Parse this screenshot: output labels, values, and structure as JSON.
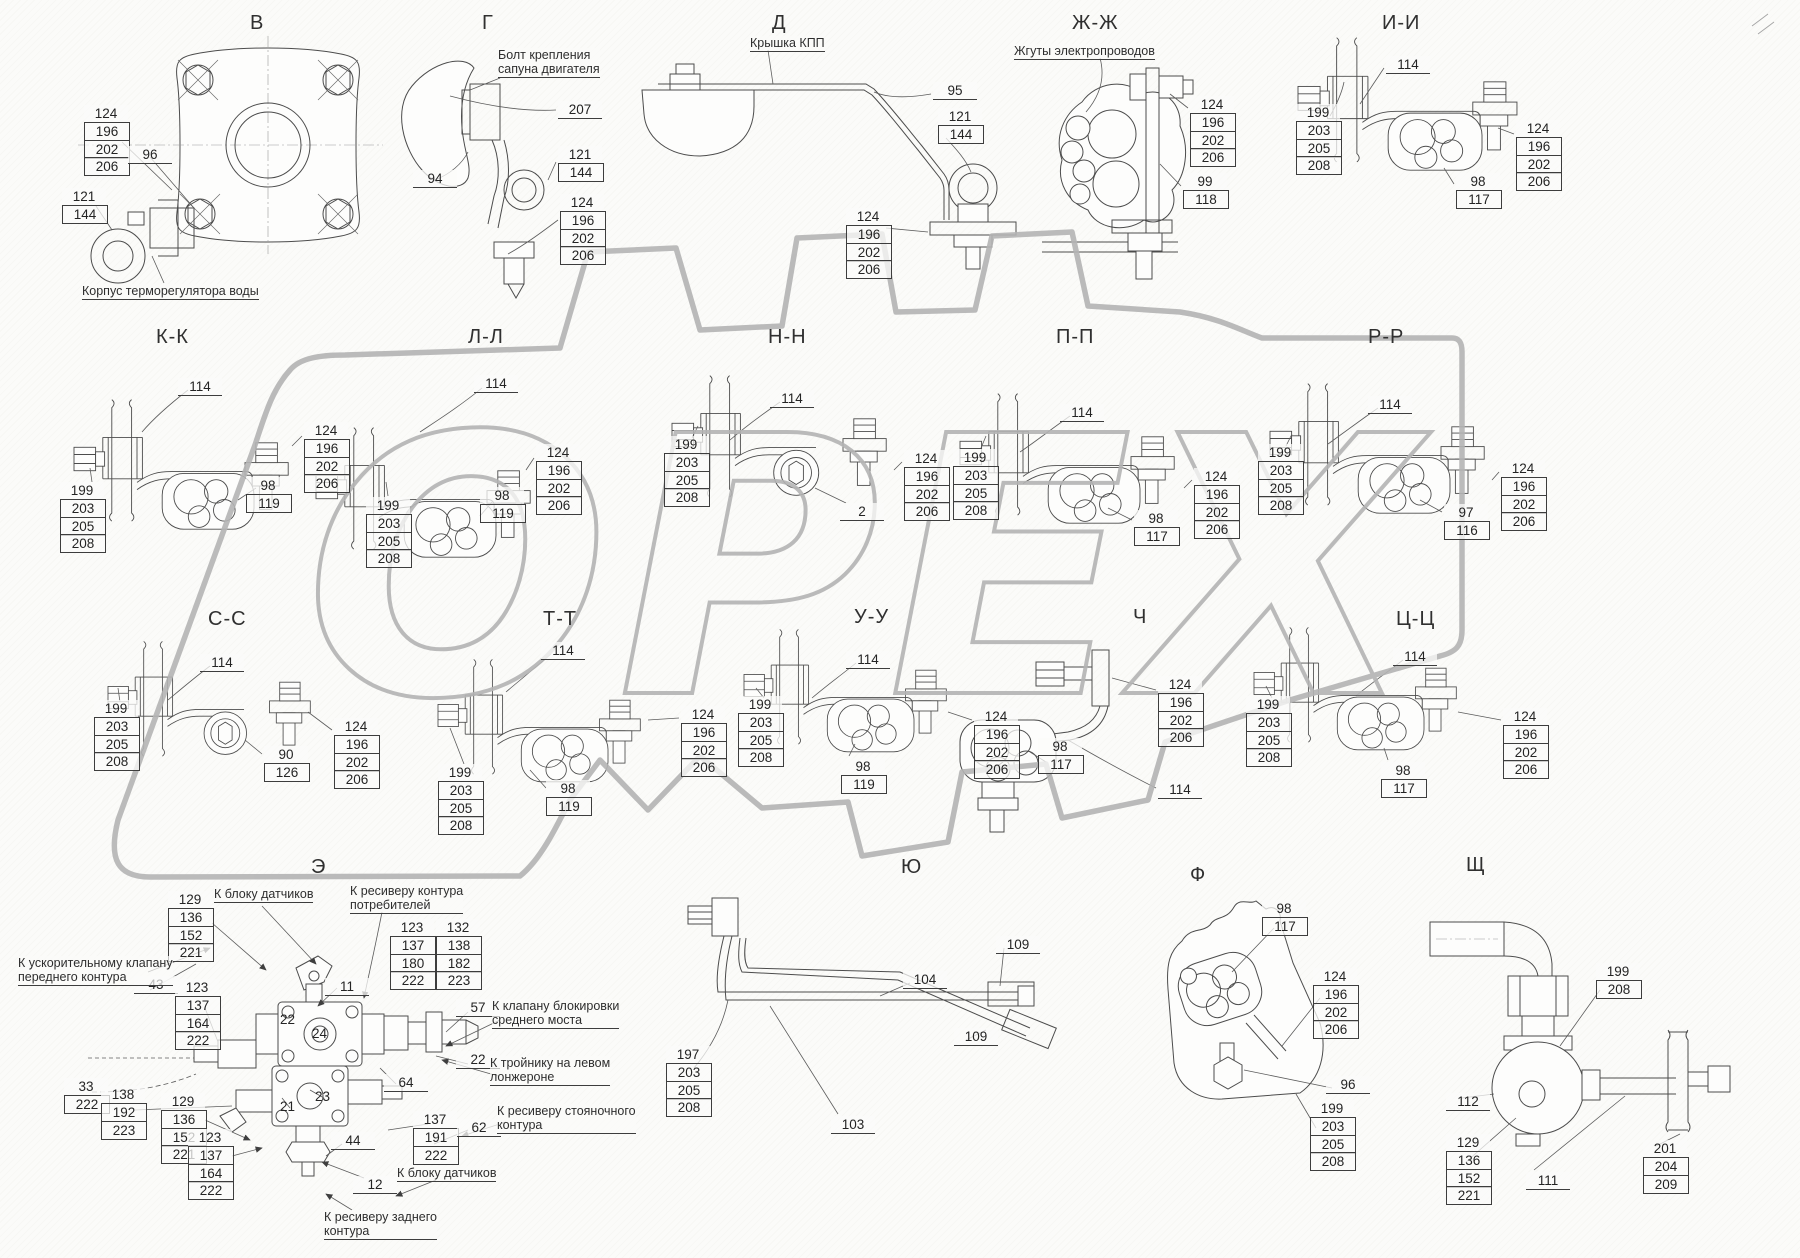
{
  "watermark": {
    "text": "ОРЕХ",
    "color": "#b4b4b4"
  },
  "sections": [
    {
      "key": "v",
      "title": "В",
      "x": 250,
      "y": 12,
      "callouts": [
        {
          "x": 84,
          "y": 105,
          "v": [
            "124",
            "196",
            "202",
            "206"
          ]
        },
        {
          "x": 128,
          "y": 146,
          "v": [
            "96"
          ]
        },
        {
          "x": 62,
          "y": 188,
          "v": [
            "121",
            "144"
          ]
        }
      ],
      "notes": [
        {
          "x": 82,
          "y": 284,
          "lines": [
            "Корпус терморегулятора воды"
          ]
        }
      ]
    },
    {
      "key": "g",
      "title": "Г",
      "x": 482,
      "y": 12,
      "callouts": [
        {
          "x": 558,
          "y": 101,
          "v": [
            "207"
          ]
        },
        {
          "x": 413,
          "y": 170,
          "v": [
            "94"
          ]
        },
        {
          "x": 558,
          "y": 146,
          "v": [
            "121",
            "144"
          ]
        },
        {
          "x": 560,
          "y": 194,
          "v": [
            "124",
            "196",
            "202",
            "206"
          ]
        }
      ],
      "notes": [
        {
          "x": 498,
          "y": 48,
          "lines": [
            "Болт крепления",
            "сапуна двигателя"
          ]
        }
      ]
    },
    {
      "key": "d",
      "title": "Д",
      "x": 772,
      "y": 12,
      "callouts": [
        {
          "x": 933,
          "y": 82,
          "v": [
            "95"
          ]
        },
        {
          "x": 938,
          "y": 108,
          "v": [
            "121",
            "144"
          ]
        },
        {
          "x": 846,
          "y": 208,
          "v": [
            "124",
            "196",
            "202",
            "206"
          ]
        }
      ],
      "notes": [
        {
          "x": 750,
          "y": 36,
          "lines": [
            "Крышка КПП"
          ]
        }
      ]
    },
    {
      "key": "zh",
      "title": "Ж-Ж",
      "x": 1072,
      "y": 12,
      "callouts": [
        {
          "x": 1190,
          "y": 96,
          "v": [
            "124",
            "196",
            "202",
            "206"
          ]
        },
        {
          "x": 1183,
          "y": 173,
          "v": [
            "99",
            "118"
          ]
        }
      ],
      "notes": [
        {
          "x": 1014,
          "y": 44,
          "lines": [
            "Жгуты электропроводов"
          ]
        }
      ]
    },
    {
      "key": "i",
      "title": "И-И",
      "x": 1382,
      "y": 12,
      "callouts": [
        {
          "x": 1386,
          "y": 56,
          "v": [
            "114"
          ]
        },
        {
          "x": 1296,
          "y": 104,
          "v": [
            "199",
            "203",
            "205",
            "208"
          ]
        },
        {
          "x": 1516,
          "y": 120,
          "v": [
            "124",
            "196",
            "202",
            "206"
          ]
        },
        {
          "x": 1456,
          "y": 173,
          "v": [
            "98",
            "117"
          ]
        }
      ],
      "notes": []
    },
    {
      "key": "k",
      "title": "К-К",
      "x": 156,
      "y": 326,
      "callouts": [
        {
          "x": 178,
          "y": 378,
          "v": [
            "114"
          ]
        },
        {
          "x": 304,
          "y": 422,
          "v": [
            "124",
            "196",
            "202",
            "206"
          ]
        },
        {
          "x": 246,
          "y": 477,
          "v": [
            "98",
            "119"
          ]
        },
        {
          "x": 60,
          "y": 482,
          "v": [
            "199",
            "203",
            "205",
            "208"
          ]
        }
      ],
      "notes": []
    },
    {
      "key": "l",
      "title": "Л-Л",
      "x": 468,
      "y": 326,
      "callouts": [
        {
          "x": 474,
          "y": 375,
          "v": [
            "114"
          ]
        },
        {
          "x": 536,
          "y": 444,
          "v": [
            "124",
            "196",
            "202",
            "206"
          ]
        },
        {
          "x": 480,
          "y": 487,
          "v": [
            "98",
            "119"
          ]
        },
        {
          "x": 366,
          "y": 497,
          "v": [
            "199",
            "203",
            "205",
            "208"
          ]
        }
      ],
      "notes": []
    },
    {
      "key": "n",
      "title": "Н-Н",
      "x": 768,
      "y": 326,
      "callouts": [
        {
          "x": 770,
          "y": 390,
          "v": [
            "114"
          ]
        },
        {
          "x": 664,
          "y": 436,
          "v": [
            "199",
            "203",
            "205",
            "208"
          ]
        },
        {
          "x": 904,
          "y": 450,
          "v": [
            "124",
            "196",
            "202",
            "206"
          ]
        },
        {
          "x": 840,
          "y": 503,
          "v": [
            "2"
          ]
        }
      ],
      "notes": []
    },
    {
      "key": "p",
      "title": "П-П",
      "x": 1056,
      "y": 326,
      "callouts": [
        {
          "x": 1060,
          "y": 404,
          "v": [
            "114"
          ]
        },
        {
          "x": 953,
          "y": 449,
          "v": [
            "199",
            "203",
            "205",
            "208"
          ]
        },
        {
          "x": 1194,
          "y": 468,
          "v": [
            "124",
            "196",
            "202",
            "206"
          ]
        },
        {
          "x": 1134,
          "y": 510,
          "v": [
            "98",
            "117"
          ]
        }
      ],
      "notes": []
    },
    {
      "key": "r",
      "title": "Р-Р",
      "x": 1368,
      "y": 326,
      "callouts": [
        {
          "x": 1368,
          "y": 396,
          "v": [
            "114"
          ]
        },
        {
          "x": 1258,
          "y": 444,
          "v": [
            "199",
            "203",
            "205",
            "208"
          ]
        },
        {
          "x": 1444,
          "y": 504,
          "v": [
            "97",
            "116"
          ]
        },
        {
          "x": 1501,
          "y": 460,
          "v": [
            "124",
            "196",
            "202",
            "206"
          ]
        }
      ],
      "notes": []
    },
    {
      "key": "s",
      "title": "С-С",
      "x": 208,
      "y": 608,
      "callouts": [
        {
          "x": 200,
          "y": 654,
          "v": [
            "114"
          ]
        },
        {
          "x": 94,
          "y": 700,
          "v": [
            "199",
            "203",
            "205",
            "208"
          ]
        },
        {
          "x": 264,
          "y": 746,
          "v": [
            "90",
            "126"
          ]
        },
        {
          "x": 334,
          "y": 718,
          "v": [
            "124",
            "196",
            "202",
            "206"
          ]
        }
      ],
      "notes": []
    },
    {
      "key": "t",
      "title": "Т-Т",
      "x": 543,
      "y": 608,
      "callouts": [
        {
          "x": 541,
          "y": 642,
          "v": [
            "114"
          ]
        },
        {
          "x": 438,
          "y": 764,
          "v": [
            "199",
            "203",
            "205",
            "208"
          ]
        },
        {
          "x": 546,
          "y": 780,
          "v": [
            "98",
            "119"
          ]
        },
        {
          "x": 681,
          "y": 706,
          "v": [
            "124",
            "196",
            "202",
            "206"
          ]
        }
      ],
      "notes": []
    },
    {
      "key": "u",
      "title": "У-У",
      "x": 854,
      "y": 606,
      "callouts": [
        {
          "x": 846,
          "y": 651,
          "v": [
            "114"
          ]
        },
        {
          "x": 738,
          "y": 696,
          "v": [
            "199",
            "203",
            "205",
            "208"
          ]
        },
        {
          "x": 841,
          "y": 758,
          "v": [
            "98",
            "119"
          ]
        },
        {
          "x": 974,
          "y": 708,
          "v": [
            "124",
            "196",
            "202",
            "206"
          ]
        }
      ],
      "notes": []
    },
    {
      "key": "ch",
      "title": "Ч",
      "x": 1133,
      "y": 606,
      "callouts": [
        {
          "x": 1158,
          "y": 676,
          "v": [
            "124",
            "196",
            "202",
            "206"
          ]
        },
        {
          "x": 1038,
          "y": 738,
          "v": [
            "98",
            "117"
          ]
        },
        {
          "x": 1158,
          "y": 781,
          "v": [
            "114"
          ]
        }
      ],
      "notes": []
    },
    {
      "key": "ts",
      "title": "Ц-Ц",
      "x": 1396,
      "y": 608,
      "callouts": [
        {
          "x": 1393,
          "y": 648,
          "v": [
            "114"
          ]
        },
        {
          "x": 1246,
          "y": 696,
          "v": [
            "199",
            "203",
            "205",
            "208"
          ]
        },
        {
          "x": 1381,
          "y": 762,
          "v": [
            "98",
            "117"
          ]
        },
        {
          "x": 1503,
          "y": 708,
          "v": [
            "124",
            "196",
            "202",
            "206"
          ]
        }
      ],
      "notes": []
    },
    {
      "key": "e",
      "title": "Э",
      "x": 311,
      "y": 856,
      "callouts": [
        {
          "x": 168,
          "y": 891,
          "v": [
            "129",
            "136",
            "152",
            "221"
          ]
        },
        {
          "x": 390,
          "y": 919,
          "v": [
            "123",
            "137",
            "180",
            "222"
          ]
        },
        {
          "x": 436,
          "y": 919,
          "v": [
            "132",
            "138",
            "182",
            "223"
          ]
        },
        {
          "x": 134,
          "y": 976,
          "v": [
            "43"
          ]
        },
        {
          "x": 175,
          "y": 979,
          "v": [
            "123",
            "137",
            "164",
            "222"
          ]
        },
        {
          "x": 325,
          "y": 978,
          "v": [
            "11"
          ]
        },
        {
          "x": 456,
          "y": 999,
          "v": [
            "57"
          ]
        },
        {
          "x": 456,
          "y": 1051,
          "v": [
            "22"
          ]
        },
        {
          "x": 384,
          "y": 1074,
          "v": [
            "64"
          ]
        },
        {
          "x": 64,
          "y": 1078,
          "v": [
            "33",
            "222"
          ]
        },
        {
          "x": 101,
          "y": 1086,
          "v": [
            "138",
            "192",
            "223"
          ]
        },
        {
          "x": 161,
          "y": 1093,
          "v": [
            "129",
            "136",
            "152",
            "221"
          ]
        },
        {
          "x": 188,
          "y": 1129,
          "v": [
            "123",
            "137",
            "164",
            "222"
          ]
        },
        {
          "x": 331,
          "y": 1132,
          "v": [
            "44"
          ]
        },
        {
          "x": 413,
          "y": 1111,
          "v": [
            "137",
            "191",
            "222"
          ]
        },
        {
          "x": 457,
          "y": 1119,
          "v": [
            "62"
          ]
        },
        {
          "x": 353,
          "y": 1176,
          "v": [
            "12"
          ]
        }
      ],
      "marks": [
        {
          "x": 280,
          "y": 1012,
          "t": "22"
        },
        {
          "x": 312,
          "y": 1026,
          "t": "24"
        },
        {
          "x": 315,
          "y": 1089,
          "t": "23"
        },
        {
          "x": 280,
          "y": 1099,
          "t": "21"
        }
      ],
      "notes": [
        {
          "x": 214,
          "y": 887,
          "lines": [
            "К блоку датчиков"
          ]
        },
        {
          "x": 350,
          "y": 884,
          "lines": [
            "К ресиверу контура",
            "потребителей"
          ]
        },
        {
          "x": 18,
          "y": 956,
          "lines": [
            "К ускорительному клапану",
            "переднего контура"
          ]
        },
        {
          "x": 492,
          "y": 999,
          "lines": [
            "К клапану блокировки",
            "среднего моста"
          ]
        },
        {
          "x": 490,
          "y": 1056,
          "lines": [
            "К тройнику на левом",
            "лонжероне"
          ]
        },
        {
          "x": 497,
          "y": 1104,
          "lines": [
            "К ресиверу стояночного",
            "контура"
          ]
        },
        {
          "x": 397,
          "y": 1166,
          "lines": [
            "К блоку датчиков"
          ]
        },
        {
          "x": 324,
          "y": 1210,
          "lines": [
            "К ресиверу заднего",
            "контура"
          ]
        }
      ]
    },
    {
      "key": "yu",
      "title": "Ю",
      "x": 901,
      "y": 856,
      "callouts": [
        {
          "x": 903,
          "y": 971,
          "v": [
            "104"
          ]
        },
        {
          "x": 996,
          "y": 936,
          "v": [
            "109"
          ]
        },
        {
          "x": 954,
          "y": 1028,
          "v": [
            "109"
          ]
        },
        {
          "x": 831,
          "y": 1116,
          "v": [
            "103"
          ]
        },
        {
          "x": 666,
          "y": 1046,
          "v": [
            "197",
            "203",
            "205",
            "208"
          ]
        }
      ],
      "notes": []
    },
    {
      "key": "f",
      "title": "Ф",
      "x": 1190,
      "y": 864,
      "callouts": [
        {
          "x": 1262,
          "y": 900,
          "v": [
            "98",
            "117"
          ]
        },
        {
          "x": 1313,
          "y": 968,
          "v": [
            "124",
            "196",
            "202",
            "206"
          ]
        },
        {
          "x": 1326,
          "y": 1076,
          "v": [
            "96"
          ]
        },
        {
          "x": 1310,
          "y": 1100,
          "v": [
            "199",
            "203",
            "205",
            "208"
          ]
        }
      ],
      "notes": []
    },
    {
      "key": "shch",
      "title": "Щ",
      "x": 1466,
      "y": 854,
      "callouts": [
        {
          "x": 1596,
          "y": 963,
          "v": [
            "199",
            "208"
          ]
        },
        {
          "x": 1446,
          "y": 1093,
          "v": [
            "112"
          ]
        },
        {
          "x": 1446,
          "y": 1134,
          "v": [
            "129",
            "136",
            "152",
            "221"
          ]
        },
        {
          "x": 1526,
          "y": 1172,
          "v": [
            "111"
          ]
        },
        {
          "x": 1643,
          "y": 1140,
          "v": [
            "201",
            "204",
            "209"
          ]
        }
      ],
      "notes": []
    }
  ]
}
